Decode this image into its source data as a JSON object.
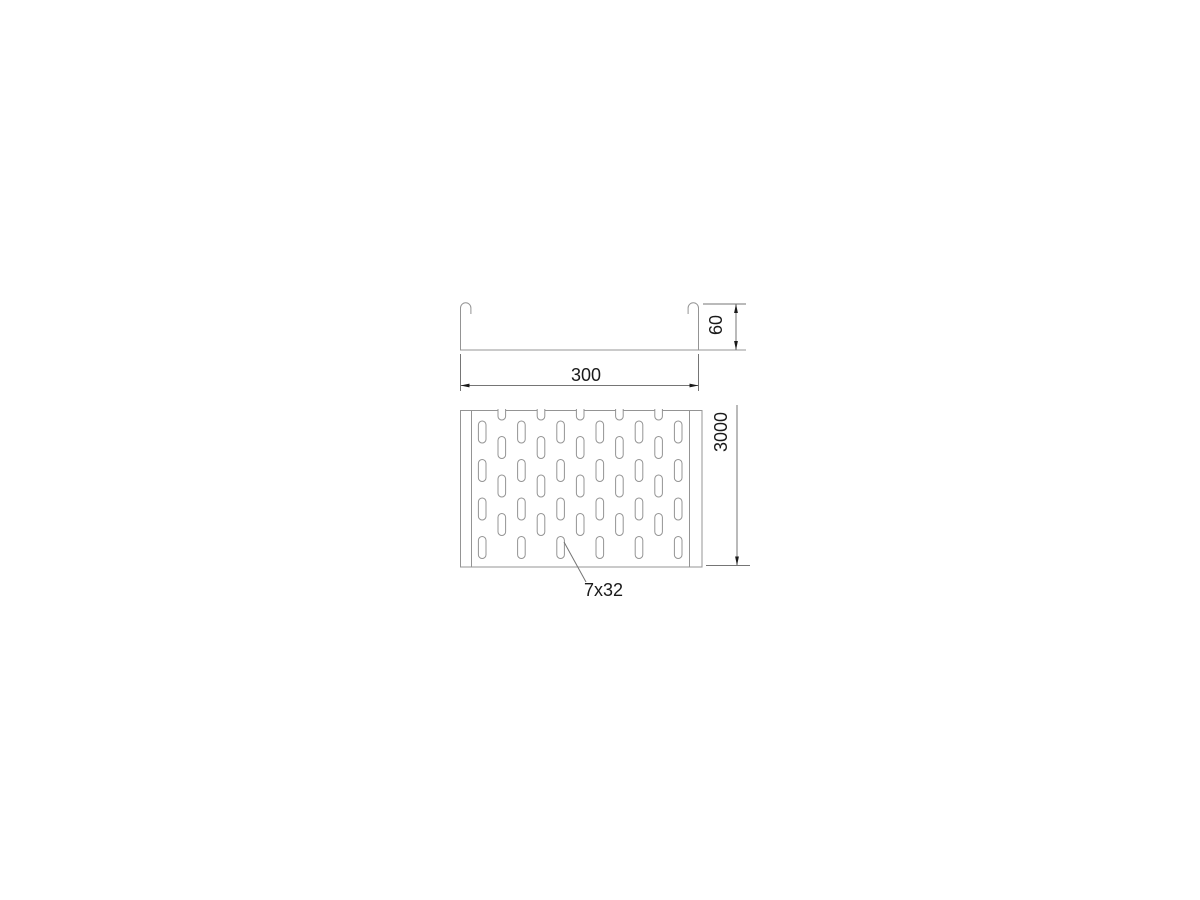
{
  "drawing": {
    "type": "cable-tray-technical-drawing",
    "colors": {
      "background": "#ffffff",
      "geometry_line": "#949494",
      "dimension_line": "#757575",
      "text": "#1a1a1a"
    },
    "cross_section": {
      "width_label": "300",
      "height_label": "60"
    },
    "plan_view": {
      "length_label": "3000",
      "perforation_label": "7x32",
      "pattern": {
        "slot_columns": 11,
        "rows_a": 4,
        "rows_b": 3,
        "top_notches": 5
      }
    }
  }
}
